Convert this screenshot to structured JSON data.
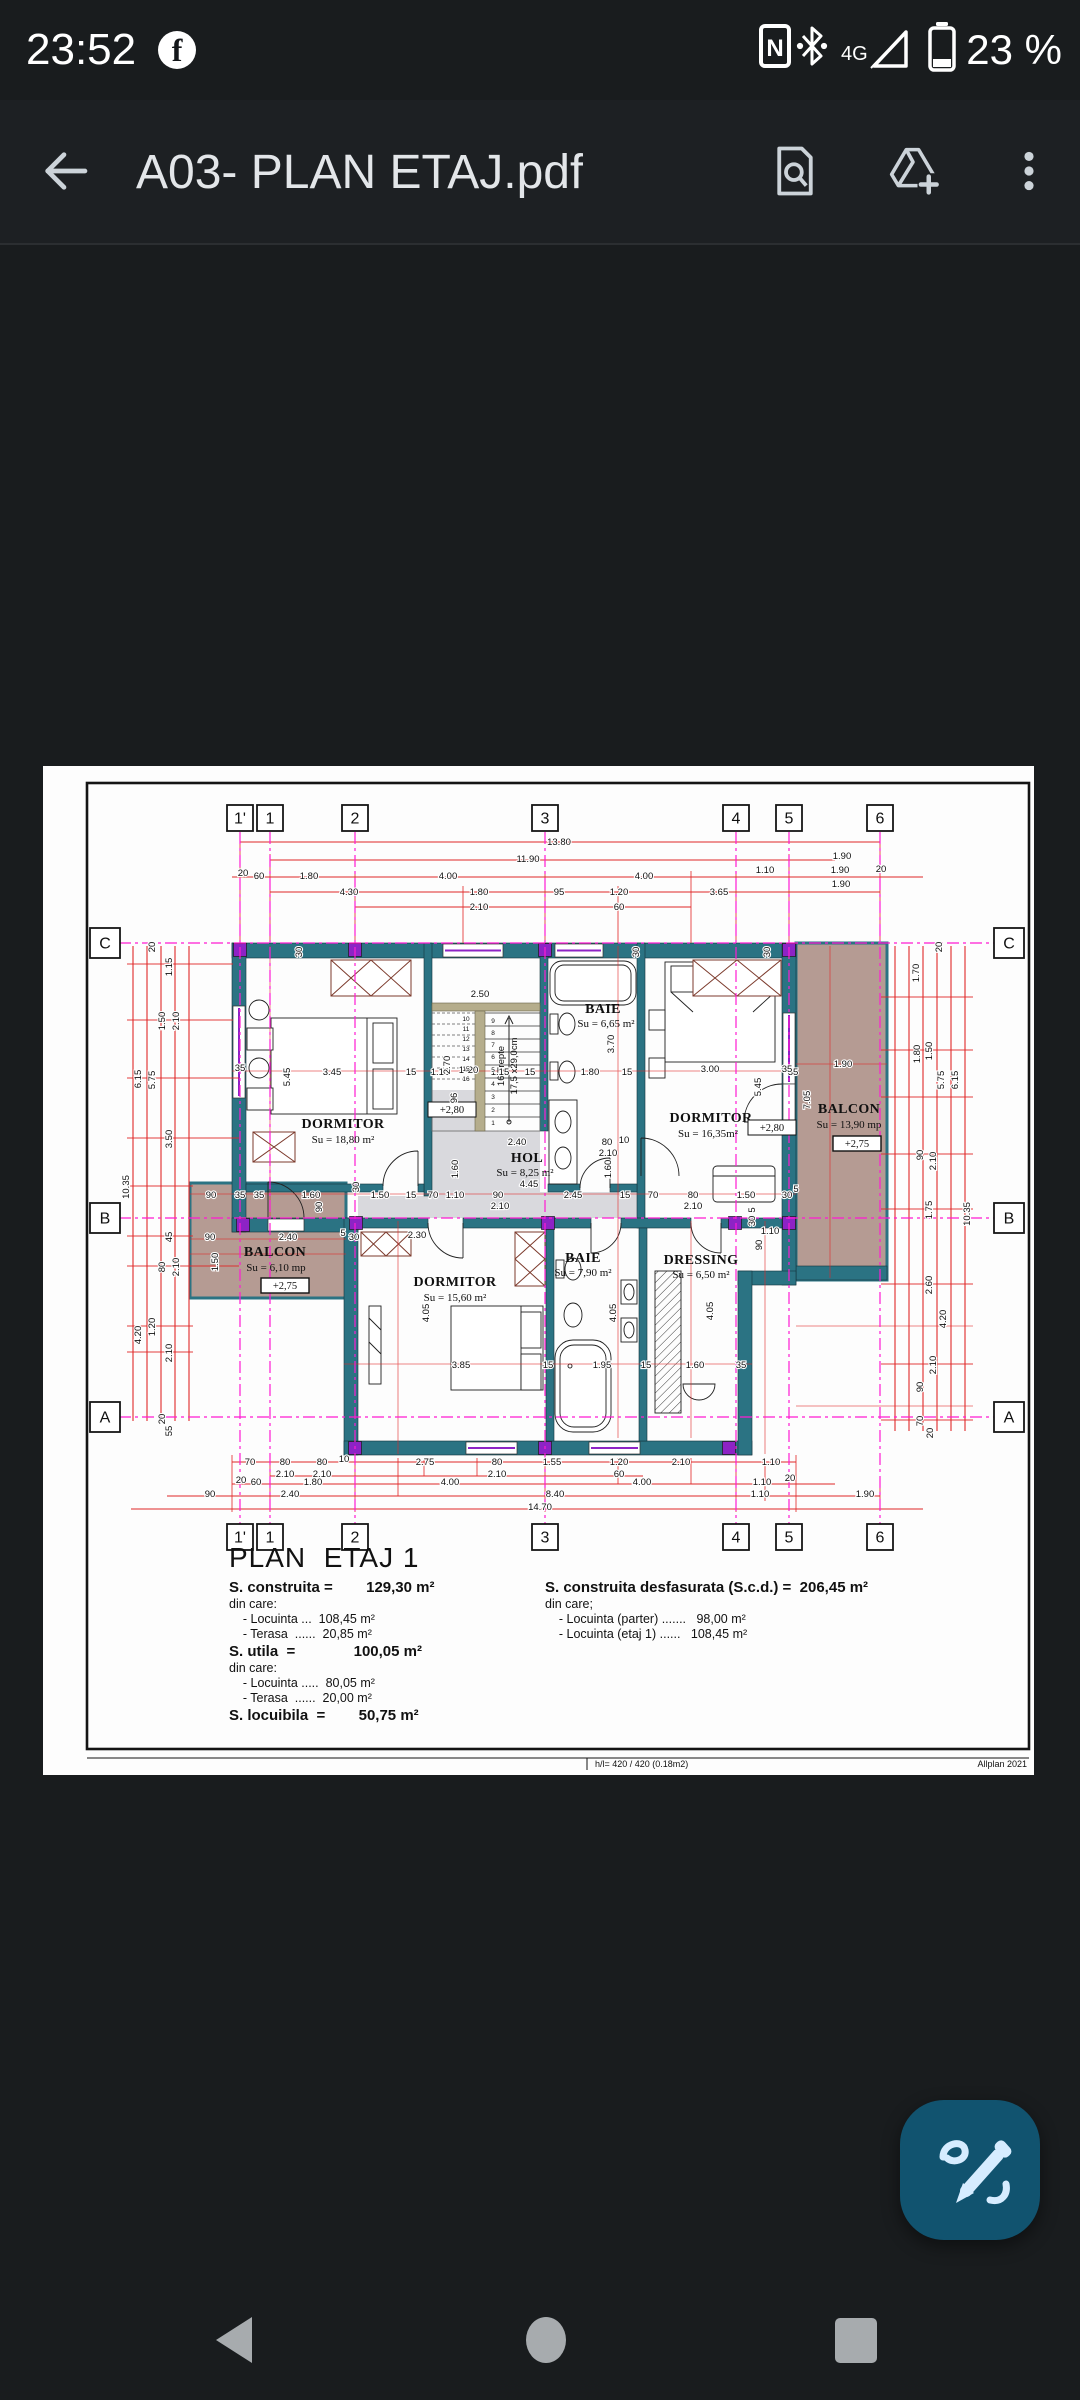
{
  "status_bar": {
    "time": "23:52",
    "network": "4G",
    "battery_pct": "23 %"
  },
  "app_bar": {
    "title": "A03- PLAN ETAJ.pdf"
  },
  "icons": {
    "status": [
      "facebook-icon",
      "nfc-icon",
      "bluetooth-icon",
      "signal-triangle-icon",
      "battery-icon"
    ],
    "appbar": [
      "back-arrow-icon",
      "find-in-page-icon",
      "add-to-drive-icon",
      "overflow-menu-icon"
    ],
    "fab": "annotate-pen-icon",
    "nav": [
      "back-triangle-icon",
      "home-circle-icon",
      "recents-square-icon"
    ]
  },
  "colors": {
    "fab": "#11536f",
    "wall_teal": "#2b7383",
    "column_purple": "#8d23c5",
    "balcony_mauve": "#b59b93",
    "hol_grey": "#d9d9dd",
    "dim_red": "#e02828",
    "grid_magenta": "#ff1bd3",
    "stair_tan": "#b5ad8c"
  },
  "plan": {
    "rooms": [
      {
        "name": "DORMITOR",
        "area": "Su = 18,80 m²"
      },
      {
        "name": "BAIE",
        "area": "Su = 6,65 m²"
      },
      {
        "name": "DORMITOR",
        "area": "Su = 16,35m²"
      },
      {
        "name": "BALCON",
        "area": "Su = 13,90 mp",
        "level": "+2,75"
      },
      {
        "name": "HOL",
        "area": "Su = 8,25 m²"
      },
      {
        "name": "BALCON",
        "area": "Su = 6,10 mp",
        "level": "+2,75"
      },
      {
        "name": "DORMITOR",
        "area": "Su = 15,60 m²"
      },
      {
        "name": "BAIE",
        "area": "Su = 7,90 m²"
      },
      {
        "name": "DRESSING",
        "area": "Su = 6,50 m²"
      }
    ],
    "levels": {
      "a": "+2,80",
      "b": "+2,80"
    },
    "stairs_note_1": "16 Trepte",
    "stairs_note_2": "17,5 x29,0cm",
    "bubbles": [
      {
        "x": 197,
        "y": 52,
        "t": "1'"
      },
      {
        "x": 227,
        "y": 52,
        "t": "1"
      },
      {
        "x": 312,
        "y": 52,
        "t": "2"
      },
      {
        "x": 502,
        "y": 52,
        "t": "3"
      },
      {
        "x": 693,
        "y": 52,
        "t": "4"
      },
      {
        "x": 746,
        "y": 52,
        "t": "5"
      },
      {
        "x": 837,
        "y": 52,
        "t": "6"
      },
      {
        "x": 197,
        "y": 771,
        "t": "1'"
      },
      {
        "x": 227,
        "y": 771,
        "t": "1"
      },
      {
        "x": 312,
        "y": 771,
        "t": "2"
      },
      {
        "x": 502,
        "y": 771,
        "t": "3"
      },
      {
        "x": 693,
        "y": 771,
        "t": "4"
      },
      {
        "x": 746,
        "y": 771,
        "t": "5"
      },
      {
        "x": 837,
        "y": 771,
        "t": "6"
      },
      {
        "x": 62,
        "y": 177,
        "t": "C",
        "w": 30
      },
      {
        "x": 62,
        "y": 452,
        "t": "B",
        "w": 30
      },
      {
        "x": 62,
        "y": 651,
        "t": "A",
        "w": 30
      },
      {
        "x": 966,
        "y": 177,
        "t": "C",
        "w": 30
      },
      {
        "x": 966,
        "y": 452,
        "t": "B",
        "w": 30
      },
      {
        "x": 966,
        "y": 651,
        "t": "A",
        "w": 30
      }
    ],
    "stair_numbers": [
      {
        "x": 423,
        "y": 255,
        "t": "10"
      },
      {
        "x": 423,
        "y": 265,
        "t": "11"
      },
      {
        "x": 423,
        "y": 275,
        "t": "12"
      },
      {
        "x": 423,
        "y": 285,
        "t": "13"
      },
      {
        "x": 423,
        "y": 295,
        "t": "14"
      },
      {
        "x": 423,
        "y": 305,
        "t": "15"
      },
      {
        "x": 423,
        "y": 315,
        "t": "16"
      },
      {
        "x": 450,
        "y": 257,
        "t": "9"
      },
      {
        "x": 450,
        "y": 269,
        "t": "8"
      },
      {
        "x": 450,
        "y": 281,
        "t": "7"
      },
      {
        "x": 450,
        "y": 293,
        "t": "6"
      },
      {
        "x": 450,
        "y": 306,
        "t": "5"
      },
      {
        "x": 450,
        "y": 320,
        "t": "4"
      },
      {
        "x": 450,
        "y": 333,
        "t": "3"
      },
      {
        "x": 450,
        "y": 346,
        "t": "2"
      },
      {
        "x": 450,
        "y": 359,
        "t": "1"
      }
    ],
    "dims": [
      {
        "t": "13.80",
        "x": 516,
        "y": 79
      },
      {
        "t": "11.90",
        "x": 485,
        "y": 96
      },
      {
        "t": "20",
        "x": 200,
        "y": 110,
        "s": 8
      },
      {
        "t": "60",
        "x": 216,
        "y": 113
      },
      {
        "t": "1.80",
        "x": 266,
        "y": 113
      },
      {
        "t": "4.00",
        "x": 405,
        "y": 113
      },
      {
        "t": "4.00",
        "x": 601,
        "y": 113
      },
      {
        "t": "1.10",
        "x": 722,
        "y": 107
      },
      {
        "t": "1.90",
        "x": 799,
        "y": 93
      },
      {
        "t": "1.90",
        "x": 797,
        "y": 107
      },
      {
        "t": "20",
        "x": 838,
        "y": 106,
        "s": 8
      },
      {
        "t": "4.30",
        "x": 306,
        "y": 129
      },
      {
        "t": "1.80",
        "x": 436,
        "y": 129
      },
      {
        "t": "95",
        "x": 516,
        "y": 129
      },
      {
        "t": "1.20",
        "x": 576,
        "y": 129
      },
      {
        "t": "3.65",
        "x": 676,
        "y": 129
      },
      {
        "t": "1.90",
        "x": 798,
        "y": 121
      },
      {
        "t": "2.10",
        "x": 436,
        "y": 144
      },
      {
        "t": "60",
        "x": 576,
        "y": 144
      },
      {
        "t": "70",
        "x": 207,
        "y": 699
      },
      {
        "t": "80",
        "x": 242,
        "y": 699
      },
      {
        "t": "80",
        "x": 279,
        "y": 699
      },
      {
        "t": "10",
        "x": 301,
        "y": 696,
        "s": 8
      },
      {
        "t": "2.75",
        "x": 382,
        "y": 699
      },
      {
        "t": "80",
        "x": 454,
        "y": 699
      },
      {
        "t": "1.55",
        "x": 509,
        "y": 699
      },
      {
        "t": "1.20",
        "x": 576,
        "y": 699
      },
      {
        "t": "2.10",
        "x": 638,
        "y": 699
      },
      {
        "t": "1.10",
        "x": 728,
        "y": 699
      },
      {
        "t": "2.10",
        "x": 242,
        "y": 711
      },
      {
        "t": "2.10",
        "x": 279,
        "y": 711
      },
      {
        "t": "2.10",
        "x": 454,
        "y": 711
      },
      {
        "t": "60",
        "x": 576,
        "y": 711
      },
      {
        "t": "20",
        "x": 198,
        "y": 717,
        "s": 8
      },
      {
        "t": "60",
        "x": 213,
        "y": 719
      },
      {
        "t": "1.80",
        "x": 270,
        "y": 719
      },
      {
        "t": "4.00",
        "x": 407,
        "y": 719
      },
      {
        "t": "4.00",
        "x": 599,
        "y": 719
      },
      {
        "t": "1.10",
        "x": 719,
        "y": 719
      },
      {
        "t": "20",
        "x": 747,
        "y": 715,
        "s": 8
      },
      {
        "t": "90",
        "x": 167,
        "y": 731
      },
      {
        "t": "2.40",
        "x": 247,
        "y": 731
      },
      {
        "t": "8.40",
        "x": 512,
        "y": 731
      },
      {
        "t": "1.10",
        "x": 717,
        "y": 731
      },
      {
        "t": "1.90",
        "x": 822,
        "y": 731
      },
      {
        "t": "14.70",
        "x": 497,
        "y": 744
      },
      {
        "t": "20",
        "x": 112,
        "y": 181,
        "r": -90,
        "s": 8
      },
      {
        "t": "1.15",
        "x": 129,
        "y": 201,
        "r": -90
      },
      {
        "t": "1.50",
        "x": 122,
        "y": 255,
        "r": -90
      },
      {
        "t": "2.10",
        "x": 136,
        "y": 255,
        "r": -90
      },
      {
        "t": "6.15",
        "x": 98,
        "y": 313,
        "r": -90
      },
      {
        "t": "5.75",
        "x": 112,
        "y": 314,
        "r": -90
      },
      {
        "t": "3.50",
        "x": 129,
        "y": 373,
        "r": -90
      },
      {
        "t": "10.35",
        "x": 86,
        "y": 421,
        "r": -90
      },
      {
        "t": "45",
        "x": 129,
        "y": 471,
        "r": -90,
        "s": 8
      },
      {
        "t": "80",
        "x": 122,
        "y": 501,
        "r": -90,
        "s": 8
      },
      {
        "t": "2.10",
        "x": 136,
        "y": 501,
        "r": -90
      },
      {
        "t": "1.20",
        "x": 112,
        "y": 561,
        "r": -90
      },
      {
        "t": "4.20",
        "x": 98,
        "y": 569,
        "r": -90
      },
      {
        "t": "2.10",
        "x": 129,
        "y": 587,
        "r": -90
      },
      {
        "t": "20",
        "x": 122,
        "y": 653,
        "r": -90,
        "s": 8
      },
      {
        "t": "55",
        "x": 129,
        "y": 665,
        "r": -90,
        "s": 8
      },
      {
        "t": "20",
        "x": 899,
        "y": 181,
        "r": -90,
        "s": 8
      },
      {
        "t": "1.70",
        "x": 876,
        "y": 207,
        "r": -90
      },
      {
        "t": "1.80",
        "x": 877,
        "y": 288,
        "r": -90
      },
      {
        "t": "1.50",
        "x": 889,
        "y": 285,
        "r": -90
      },
      {
        "t": "5.75",
        "x": 901,
        "y": 314,
        "r": -90
      },
      {
        "t": "6.15",
        "x": 915,
        "y": 314,
        "r": -90
      },
      {
        "t": "7.05",
        "x": 767,
        "y": 334,
        "r": -90,
        "s": 11
      },
      {
        "t": "90",
        "x": 880,
        "y": 389,
        "r": -90,
        "s": 8
      },
      {
        "t": "2.10",
        "x": 893,
        "y": 395,
        "r": -90
      },
      {
        "t": "1.75",
        "x": 889,
        "y": 444,
        "r": -90
      },
      {
        "t": "10.35",
        "x": 927,
        "y": 448,
        "r": -90
      },
      {
        "t": "2.60",
        "x": 889,
        "y": 519,
        "r": -90
      },
      {
        "t": "4.20",
        "x": 903,
        "y": 553,
        "r": -90
      },
      {
        "t": "2.10",
        "x": 893,
        "y": 599,
        "r": -90
      },
      {
        "t": "90",
        "x": 880,
        "y": 621,
        "r": -90,
        "s": 8
      },
      {
        "t": "70",
        "x": 880,
        "y": 655,
        "r": -90,
        "s": 8
      },
      {
        "t": "20",
        "x": 890,
        "y": 667,
        "r": -90,
        "s": 8
      },
      {
        "t": "1.90",
        "x": 800,
        "y": 301
      },
      {
        "t": "35",
        "x": 750,
        "y": 309,
        "s": 8
      },
      {
        "t": "2.50",
        "x": 437,
        "y": 231
      },
      {
        "t": "3.70",
        "x": 571,
        "y": 278,
        "r": -90
      },
      {
        "t": "3.45",
        "x": 289,
        "y": 309
      },
      {
        "t": "35",
        "x": 197,
        "y": 305,
        "s": 8
      },
      {
        "t": "5.45",
        "x": 247,
        "y": 311,
        "r": -90
      },
      {
        "t": "15",
        "x": 368,
        "y": 309,
        "s": 8
      },
      {
        "t": "1.15",
        "x": 397,
        "y": 309
      },
      {
        "t": "2.70",
        "x": 407,
        "y": 299,
        "r": -90,
        "s": 8
      },
      {
        "t": "14",
        "x": 421,
        "y": 307,
        "s": 7
      },
      {
        "t": "20",
        "x": 430,
        "y": 307,
        "s": 7
      },
      {
        "t": "1.15",
        "x": 457,
        "y": 309
      },
      {
        "t": "15",
        "x": 487,
        "y": 309,
        "s": 8
      },
      {
        "t": "1.80",
        "x": 547,
        "y": 309
      },
      {
        "t": "15",
        "x": 584,
        "y": 309,
        "s": 8
      },
      {
        "t": "3.00",
        "x": 667,
        "y": 306
      },
      {
        "t": "35",
        "x": 744,
        "y": 306,
        "s": 8
      },
      {
        "t": "5.45",
        "x": 718,
        "y": 321,
        "r": -90
      },
      {
        "t": "96",
        "x": 414,
        "y": 332,
        "r": -90,
        "s": 8
      },
      {
        "t": "30",
        "x": 259,
        "y": 186,
        "r": -90,
        "s": 7
      },
      {
        "t": "30",
        "x": 596,
        "y": 186,
        "r": -90,
        "s": 7
      },
      {
        "t": "30",
        "x": 727,
        "y": 186,
        "r": -90,
        "s": 7
      },
      {
        "t": "2.40",
        "x": 474,
        "y": 379
      },
      {
        "t": "80",
        "x": 564,
        "y": 379,
        "s": 8
      },
      {
        "t": "10",
        "x": 581,
        "y": 377,
        "s": 7
      },
      {
        "t": "2.10",
        "x": 565,
        "y": 390
      },
      {
        "t": "1.60",
        "x": 415,
        "y": 403,
        "r": -90,
        "s": 8
      },
      {
        "t": "1.60",
        "x": 568,
        "y": 403,
        "r": -90,
        "s": 8
      },
      {
        "t": "90",
        "x": 168,
        "y": 432,
        "s": 8
      },
      {
        "t": "35",
        "x": 197,
        "y": 432,
        "s": 8
      },
      {
        "t": "35",
        "x": 216,
        "y": 432,
        "s": 8
      },
      {
        "t": "1.60",
        "x": 268,
        "y": 432
      },
      {
        "t": "30",
        "x": 316,
        "y": 421,
        "r": -90,
        "s": 8
      },
      {
        "t": "1.50",
        "x": 337,
        "y": 432
      },
      {
        "t": "15",
        "x": 368,
        "y": 432,
        "s": 8
      },
      {
        "t": "70",
        "x": 390,
        "y": 432,
        "s": 8
      },
      {
        "t": "1.10",
        "x": 412,
        "y": 432
      },
      {
        "t": "90",
        "x": 455,
        "y": 432,
        "s": 8
      },
      {
        "t": "2.10",
        "x": 457,
        "y": 443
      },
      {
        "t": "4.45",
        "x": 486,
        "y": 421
      },
      {
        "t": "2.45",
        "x": 530,
        "y": 432
      },
      {
        "t": "15",
        "x": 582,
        "y": 432,
        "s": 8
      },
      {
        "t": "70",
        "x": 610,
        "y": 432,
        "s": 8
      },
      {
        "t": "80",
        "x": 650,
        "y": 432,
        "s": 8
      },
      {
        "t": "2.10",
        "x": 650,
        "y": 443
      },
      {
        "t": "1.50",
        "x": 703,
        "y": 432
      },
      {
        "t": "30",
        "x": 744,
        "y": 432,
        "s": 8
      },
      {
        "t": "5",
        "x": 753,
        "y": 426,
        "s": 7
      },
      {
        "t": "1.10",
        "x": 727,
        "y": 468
      },
      {
        "t": "90",
        "x": 719,
        "y": 479,
        "r": -90,
        "s": 8
      },
      {
        "t": "5",
        "x": 712,
        "y": 444,
        "s": 7,
        "r": -90
      },
      {
        "t": "30",
        "x": 712,
        "y": 455,
        "r": -90,
        "s": 8
      },
      {
        "t": "90",
        "x": 279,
        "y": 441,
        "r": -90,
        "s": 8
      },
      {
        "t": "90",
        "x": 167,
        "y": 474,
        "s": 8
      },
      {
        "t": "2.40",
        "x": 245,
        "y": 474
      },
      {
        "t": "5",
        "x": 300,
        "y": 470,
        "s": 7
      },
      {
        "t": "30",
        "x": 311,
        "y": 474,
        "s": 8
      },
      {
        "t": "1.50",
        "x": 175,
        "y": 496,
        "r": -90
      },
      {
        "t": "2.30",
        "x": 374,
        "y": 472
      },
      {
        "t": "3.85",
        "x": 418,
        "y": 602
      },
      {
        "t": "15",
        "x": 505,
        "y": 602,
        "s": 8
      },
      {
        "t": "1.95",
        "x": 559,
        "y": 602
      },
      {
        "t": "15",
        "x": 603,
        "y": 602,
        "s": 8
      },
      {
        "t": "1.60",
        "x": 652,
        "y": 602
      },
      {
        "t": "35",
        "x": 698,
        "y": 602,
        "s": 8
      },
      {
        "t": "4.05",
        "x": 386,
        "y": 547,
        "r": -90
      },
      {
        "t": "4.05",
        "x": 573,
        "y": 547,
        "r": -90
      },
      {
        "t": "4.05",
        "x": 670,
        "y": 545,
        "r": -90
      }
    ],
    "summary": {
      "title": "PLAN  ETAJ 1",
      "left": [
        {
          "text": "S. construita =        129,30 m²"
        },
        {
          "text": "din care:"
        },
        {
          "text": "    - Locuinta ...  108,45 m²"
        },
        {
          "text": "    - Terasa  ......  20,85 m²"
        },
        {
          "text": "S. utila  =              100,05 m²"
        },
        {
          "text": "din care:"
        },
        {
          "text": "    - Locuinta .....  80,05 m²"
        },
        {
          "text": "    - Terasa  ......  20,00 m²"
        },
        {
          "text": "S. locuibila  =        50,75 m²"
        }
      ],
      "right": [
        {
          "text": "S. construita desfasurata (S.c.d.) =  206,45 m²"
        },
        {
          "text": "din care;"
        },
        {
          "text": "    - Locuinta (parter) .......   98,00 m²"
        },
        {
          "text": "    - Locuinta (etaj 1) ......   108,45 m²"
        }
      ]
    },
    "footer": {
      "left": "h/l= 420 / 420 (0.18m2)",
      "right": "Allplan 2021"
    }
  }
}
